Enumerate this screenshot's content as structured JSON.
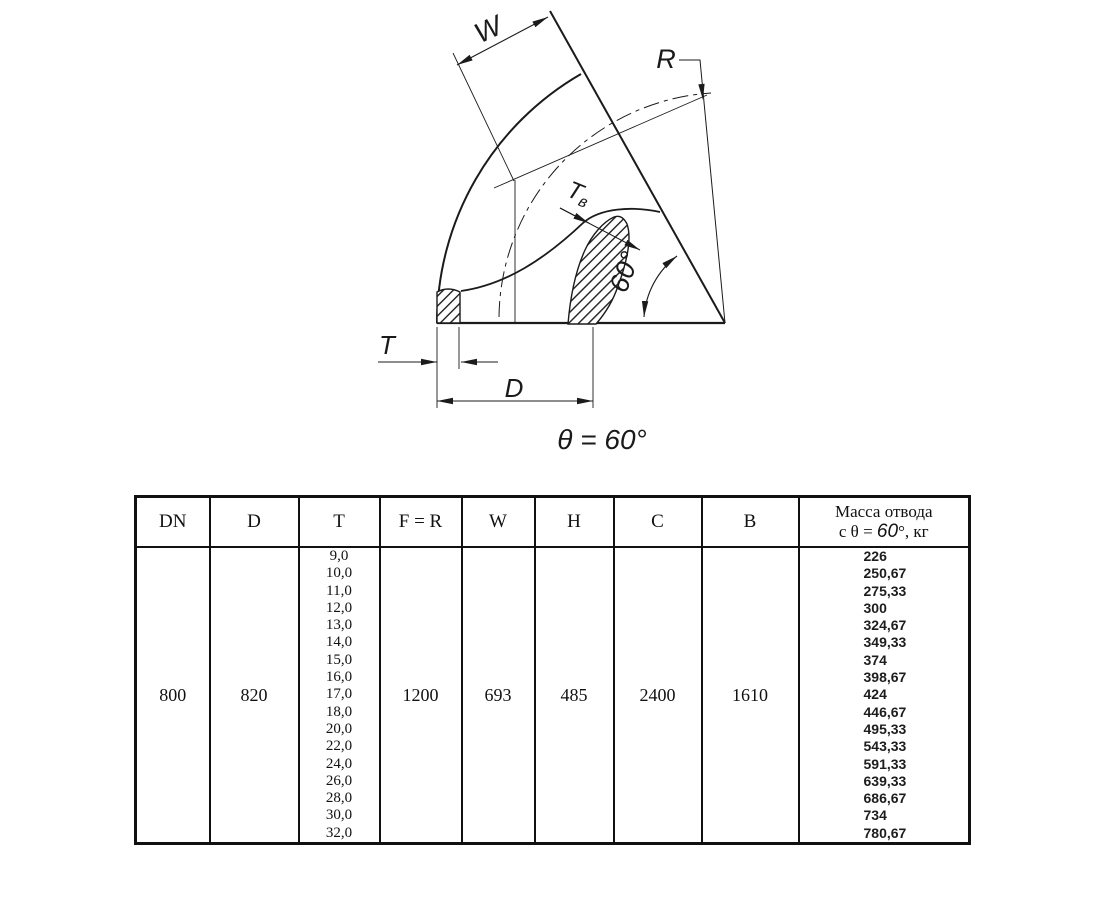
{
  "drawing": {
    "caption": "θ = 60°",
    "labels": {
      "w": "W",
      "r": "R",
      "tv_main": "T",
      "tv_sub": "в",
      "t": "T",
      "d": "D",
      "angle": "60°"
    }
  },
  "table": {
    "headers": {
      "dn": "DN",
      "d": "D",
      "t": "T",
      "fr": "F = R",
      "w": "W",
      "h": "H",
      "c": "C",
      "b": "B",
      "mass_line1": "Масса отвода",
      "mass_prefix": "с θ = ",
      "mass_angle": "60",
      "mass_suffix": "°, кг"
    },
    "row": {
      "dn": "800",
      "d": "820",
      "fr": "1200",
      "w": "693",
      "h": "485",
      "c": "2400",
      "b": "1610",
      "t_values": [
        "9,0",
        "10,0",
        "11,0",
        "12,0",
        "13,0",
        "14,0",
        "15,0",
        "16,0",
        "17,0",
        "18,0",
        "20,0",
        "22,0",
        "24,0",
        "26,0",
        "28,0",
        "30,0",
        "32,0"
      ],
      "mass_values": [
        "226",
        "250,67",
        "275,33",
        "300",
        "324,67",
        "349,33",
        "374",
        "398,67",
        "424",
        "446,67",
        "495,33",
        "543,33",
        "591,33",
        "639,33",
        "686,67",
        "734",
        "780,67"
      ]
    }
  }
}
